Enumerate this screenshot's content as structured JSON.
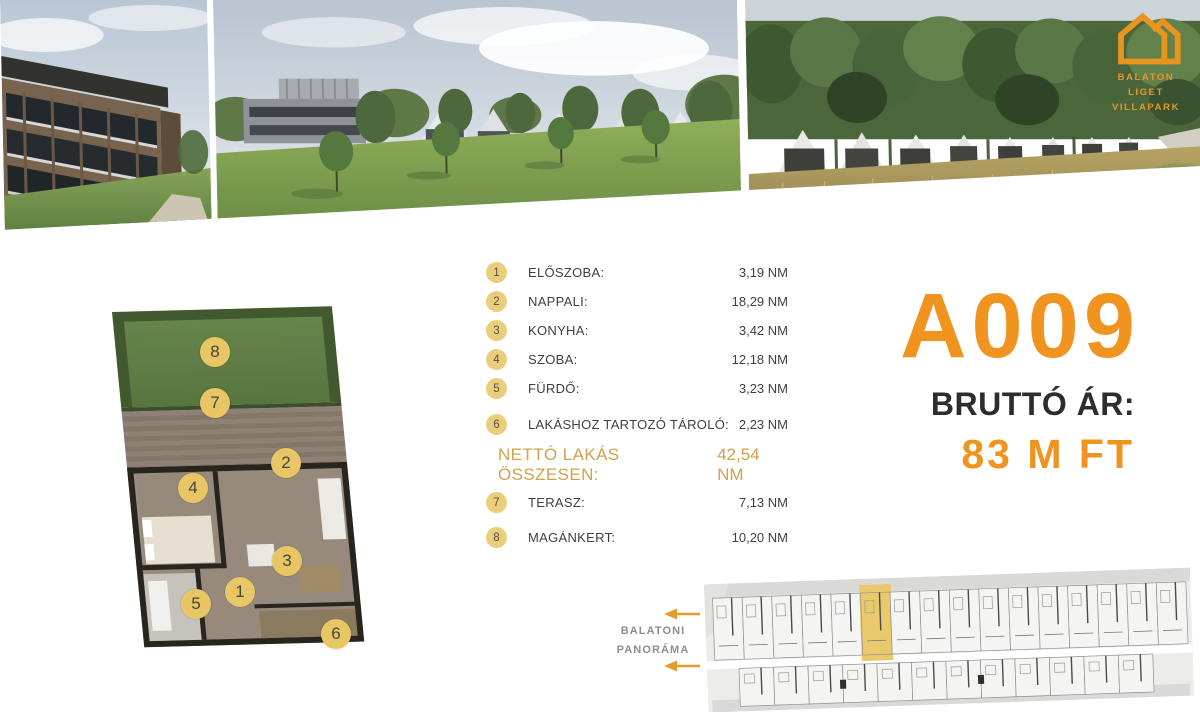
{
  "logo": {
    "line1": "BALATON LIGET",
    "line2": "VILLAPARK"
  },
  "unit": {
    "code": "A009",
    "price_label": "BRUTTÓ ÁR:",
    "price_value": "83 M FT"
  },
  "rooms": [
    {
      "number": "1",
      "label": "ELŐSZOBA:",
      "value": "3,19 NM"
    },
    {
      "number": "2",
      "label": "NAPPALI:",
      "value": "18,29 NM"
    },
    {
      "number": "3",
      "label": "KONYHA:",
      "value": "3,42 NM"
    },
    {
      "number": "4",
      "label": "SZOBA:",
      "value": "12,18 NM"
    },
    {
      "number": "5",
      "label": "FÜRDŐ:",
      "value": "3,23 NM"
    },
    {
      "number": "6",
      "label": "LAKÁSHOZ TARTOZÓ TÁROLÓ:",
      "value": "2,23 NM"
    }
  ],
  "total": {
    "label": "NETTÓ LAKÁS ÖSSZESEN:",
    "value": "42,54 NM"
  },
  "outdoor": [
    {
      "number": "7",
      "label": "TERASZ:",
      "value": "7,13 NM"
    },
    {
      "number": "8",
      "label": "MAGÁNKERT:",
      "value": "10,20 NM"
    }
  ],
  "floorplan": {
    "markers": [
      "1",
      "2",
      "3",
      "4",
      "5",
      "6",
      "7",
      "8"
    ]
  },
  "siteplan": {
    "caption_line1": "BALATONI",
    "caption_line2": "PANORÁMA"
  },
  "colors": {
    "accent_orange": "#F0941F",
    "logo_orange": "#E8951F",
    "badge_gold": "#EBCE7C",
    "plan_marker_gold": "#E8C666",
    "netto_gold": "#D0A24E",
    "siteplan_highlight": "#E9C96B",
    "text_dark": "#3F4043",
    "caption_gray": "#8D8D8D"
  }
}
